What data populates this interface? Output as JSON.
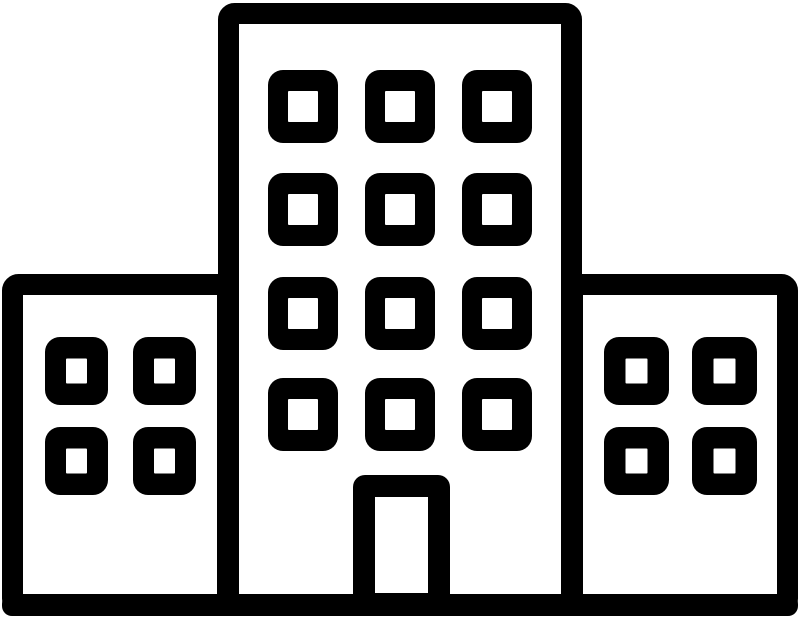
{
  "meta": {
    "background_color": "#ffffff",
    "stroke_color": "#000000"
  },
  "icon": {
    "name": "office-buildings-icon",
    "description": "Black outline icon of a tall central building flanked by two shorter wings, each with square grid windows, a central entrance door, standing on a ground line",
    "canvas": {
      "width": 800,
      "height": 618
    },
    "stroke_width": 21,
    "building_corner_radius": 6,
    "ground": {
      "x": 2,
      "y": 594,
      "width": 796,
      "height": 22,
      "radius": 10
    },
    "buildings": [
      {
        "id": "left-wing",
        "x": 2,
        "y": 274,
        "width": 236,
        "height": 341,
        "windows": {
          "cols_x": [
            45,
            133
          ],
          "rows_y": [
            337,
            427
          ],
          "width": 63,
          "height": 68,
          "pane_width": 21,
          "pane_height": 25,
          "radius": 15
        }
      },
      {
        "id": "center-tower",
        "x": 218,
        "y": 3,
        "width": 364,
        "height": 612,
        "windows": {
          "cols_x": [
            268,
            365,
            462
          ],
          "rows_y": [
            70,
            173,
            277,
            378
          ],
          "width": 70,
          "height": 73,
          "pane_width": 30,
          "pane_height": 31,
          "radius": 15
        },
        "door": {
          "x": 353,
          "y": 475,
          "width": 97,
          "height": 140,
          "radius": 12,
          "pane_x": 375,
          "pane_y": 497,
          "pane_width": 53,
          "pane_height": 96
        }
      },
      {
        "id": "right-wing",
        "x": 562,
        "y": 274,
        "width": 236,
        "height": 341,
        "windows": {
          "cols_x": [
            604,
            692
          ],
          "rows_y": [
            337,
            427
          ],
          "width": 65,
          "height": 68,
          "pane_width": 22,
          "pane_height": 25,
          "radius": 15
        }
      }
    ]
  }
}
